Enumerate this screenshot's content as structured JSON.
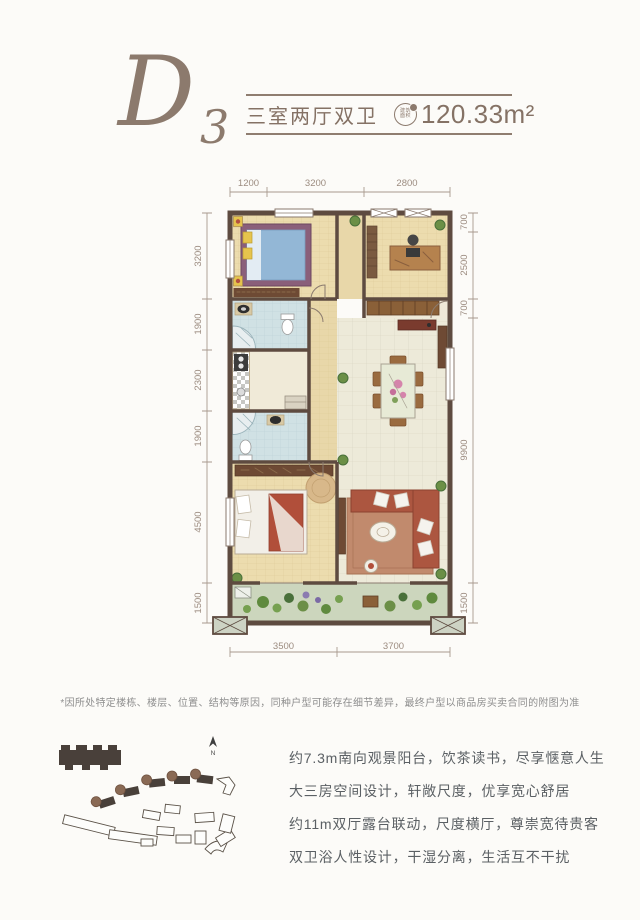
{
  "header": {
    "plan_code_letter": "D",
    "plan_code_number": "3",
    "title": "三室两厅双卫",
    "badge_line1": "建筑",
    "badge_line2": "面积",
    "area": "120.33m²"
  },
  "palette": {
    "accent": "#8c7a6d",
    "wall": "#5e4b40",
    "dim_text": "#9c8c80",
    "wood_floor": "#ecdcae",
    "tile_floor": "#edead9",
    "bath_tile": "#d0e1e4",
    "balcony": "#ccd6bd",
    "sofa": "#ac5640",
    "bed_blue": "#93b7d6",
    "rug": "#c18a6d"
  },
  "floorplan": {
    "dims_top": [
      "1200",
      "3200",
      "2800"
    ],
    "dims_left": [
      "3200",
      "1900",
      "2300",
      "1900",
      "4500",
      "1500"
    ],
    "dims_right": [
      "700",
      "2500",
      "700",
      "9900",
      "1500"
    ],
    "dims_bottom": [
      "3500",
      "3700"
    ]
  },
  "disclaimer": "*因所处特定楼栋、楼层、位置、结构等原因，同种户型可能存在细节差异，最终户型以商品房买卖合同的附图为准",
  "siteplan": {
    "compass_label": "N"
  },
  "features": [
    "约7.3m南向观景阳台，饮茶读书，尽享惬意人生",
    "大三房空间设计，轩敞尺度，优享宽心舒居",
    "约11m双厅露台联动，尺度横厅，尊崇宽待贵客",
    "双卫浴人性设计，干湿分离，生活互不干扰"
  ]
}
